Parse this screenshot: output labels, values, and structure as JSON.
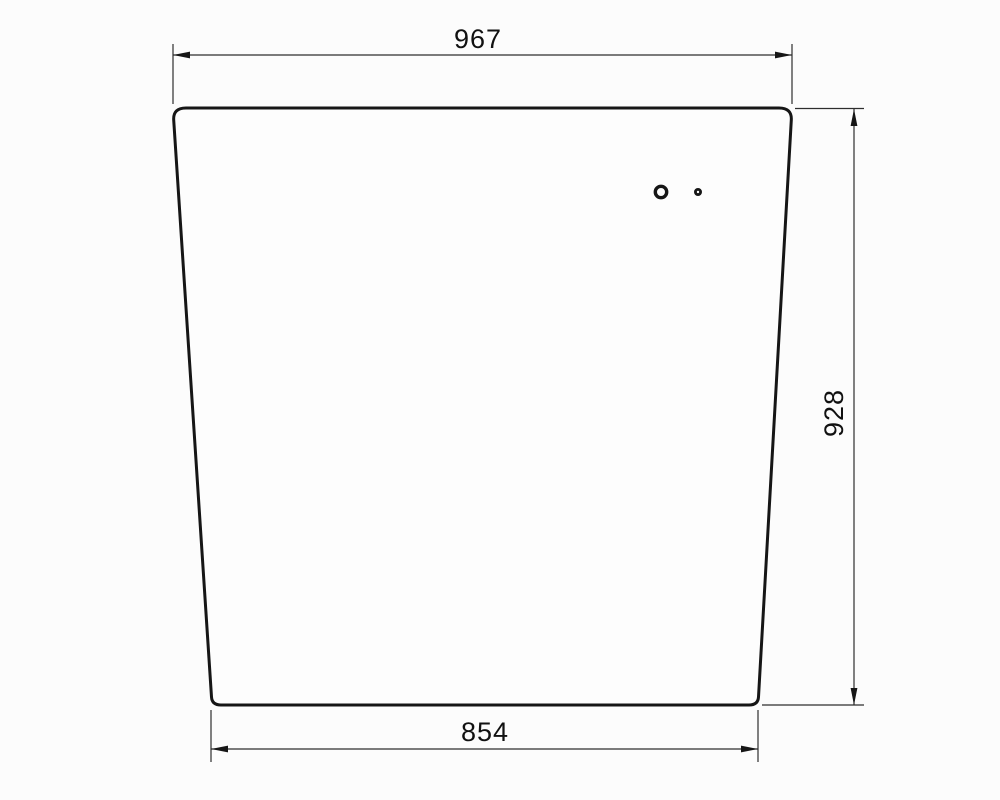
{
  "drawing": {
    "background_color": "#fcfcfc",
    "outline_color": "#161616",
    "dimension_line_color": "#2e2e2e",
    "text_color": "#111111",
    "dimensions": {
      "top_width": {
        "label": "967",
        "value": 967
      },
      "height": {
        "label": "928",
        "value": 928
      },
      "bottom_width": {
        "label": "854",
        "value": 854
      }
    },
    "holes": {
      "count": 2
    }
  }
}
